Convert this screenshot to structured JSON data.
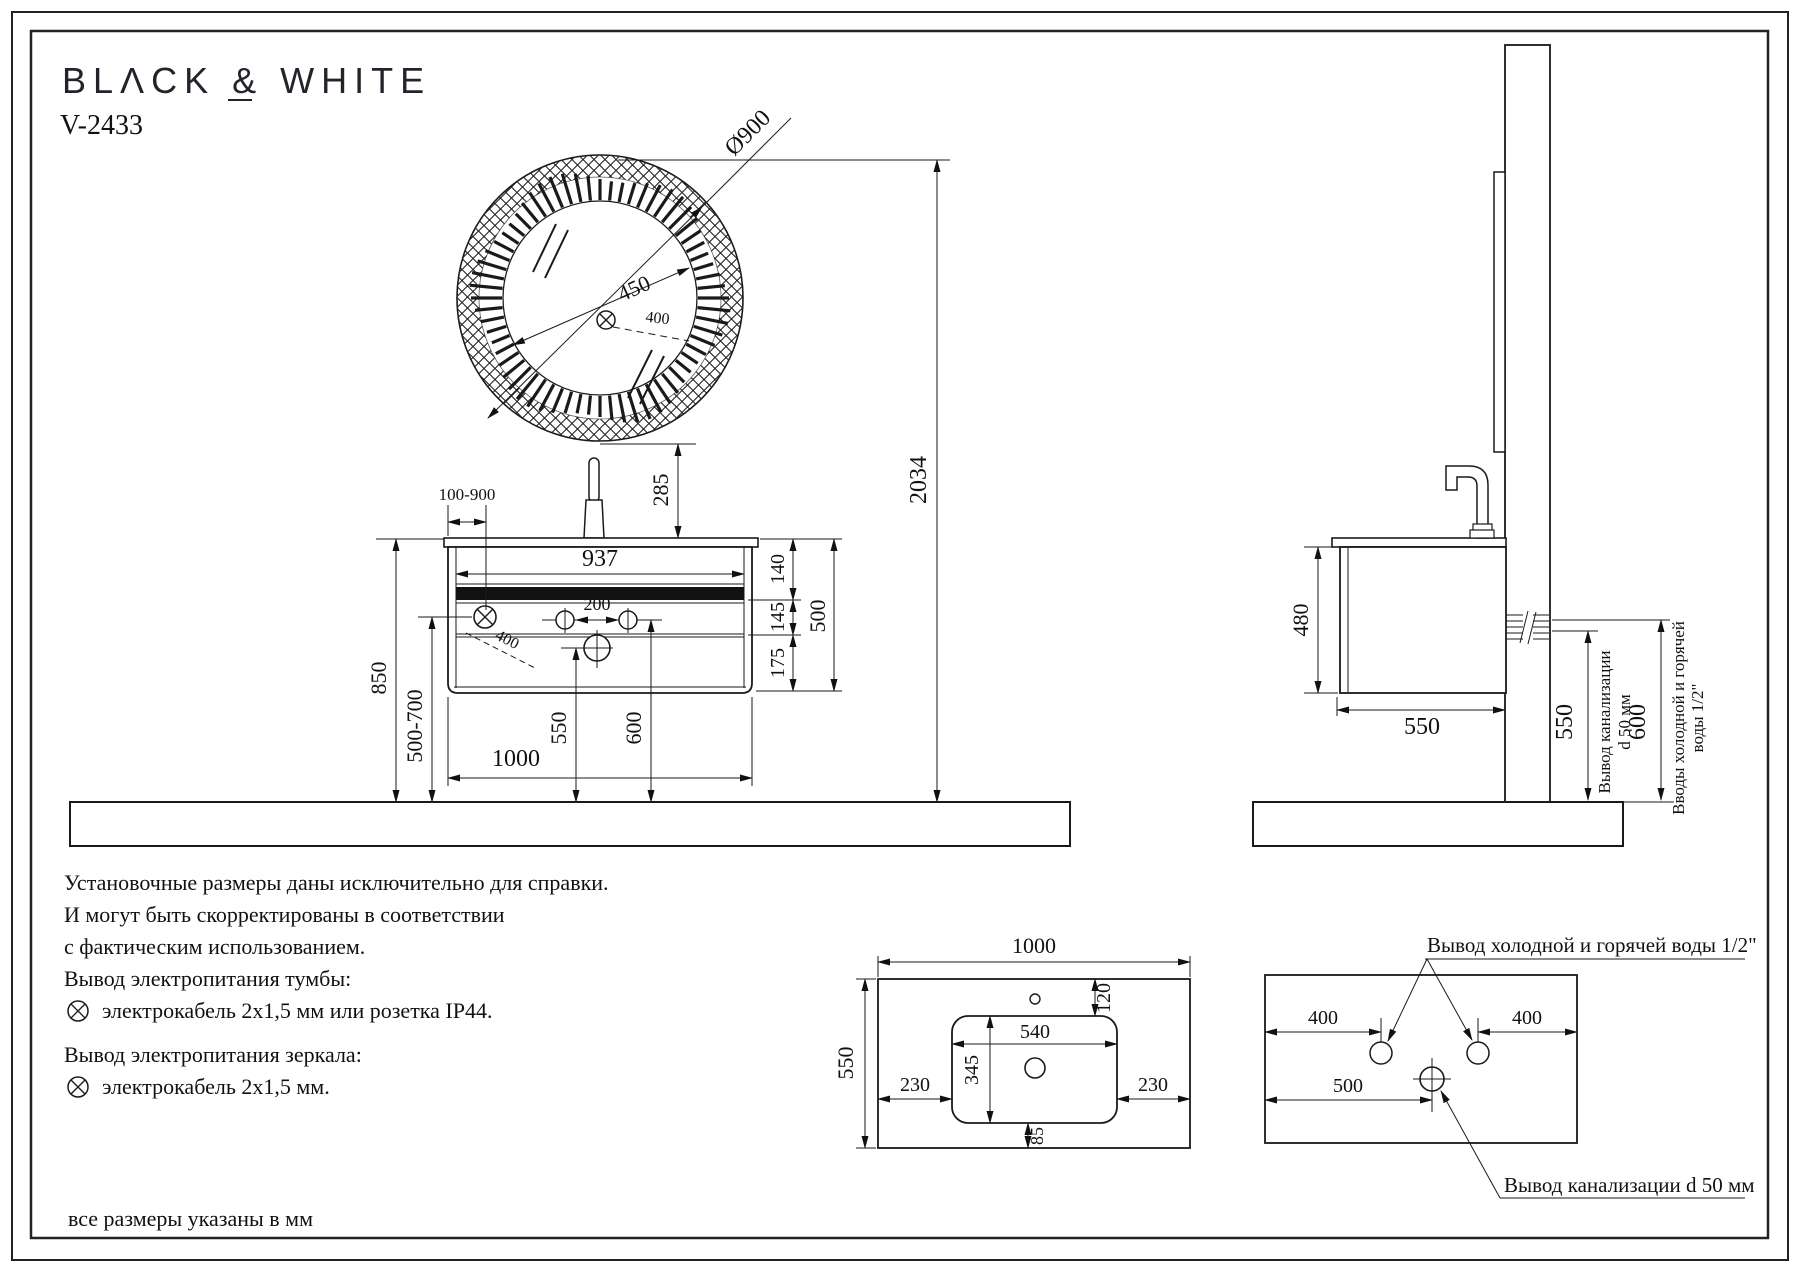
{
  "brand": "BLΛCK & WHITE",
  "model": "V-2433",
  "front_view": {
    "mirror_diameter": "Ø900",
    "mirror_radius": "450",
    "mirror_cable": "400",
    "faucet_offset_range": "100-900",
    "inner_width": "937",
    "mirror_to_counter": "285",
    "total_height": "2034",
    "seg_top": "140",
    "seg_mid": "145",
    "seg_bottom": "175",
    "cabinet_height": "500",
    "counter_height": "850",
    "outlet_height_range": "500-700",
    "holes_spacing": "200",
    "cabinet_cable": "400",
    "drain_height": "550",
    "water_height": "600",
    "cabinet_width": "1000"
  },
  "side_view": {
    "cabinet_height": "480",
    "cabinet_depth": "550",
    "drain_height": "550",
    "water_height": "600",
    "drain_note_line1": "Вывод канализации",
    "drain_note_line2": "d 50 мм",
    "water_note_line1": "Вводы холодной и горячей",
    "water_note_line2": "воды 1/2\""
  },
  "top_view": {
    "width": "1000",
    "depth": "550",
    "faucet_hole_offset": "120",
    "basin_width": "540",
    "basin_depth": "345",
    "left_margin": "230",
    "right_margin": "230",
    "basin_to_front": "85"
  },
  "wall_view": {
    "water_left_offset": "400",
    "water_right_offset": "400",
    "drain_offset": "500",
    "water_label": "Вывод холодной и горячей воды 1/2\"",
    "drain_label": "Вывод канализации d 50 мм"
  },
  "notes": {
    "line1": "Установочные размеры даны исключительно для справки.",
    "line2": "И могут быть скорректированы в соответствии",
    "line3": "с фактическим использованием.",
    "line4": "Вывод электропитания тумбы:",
    "line5": "электрокабель 2х1,5 мм или розетка IP44.",
    "line6": "Вывод электропитания зеркала:",
    "line7": "электрокабель 2х1,5 мм.",
    "footer": "все размеры указаны в мм"
  }
}
